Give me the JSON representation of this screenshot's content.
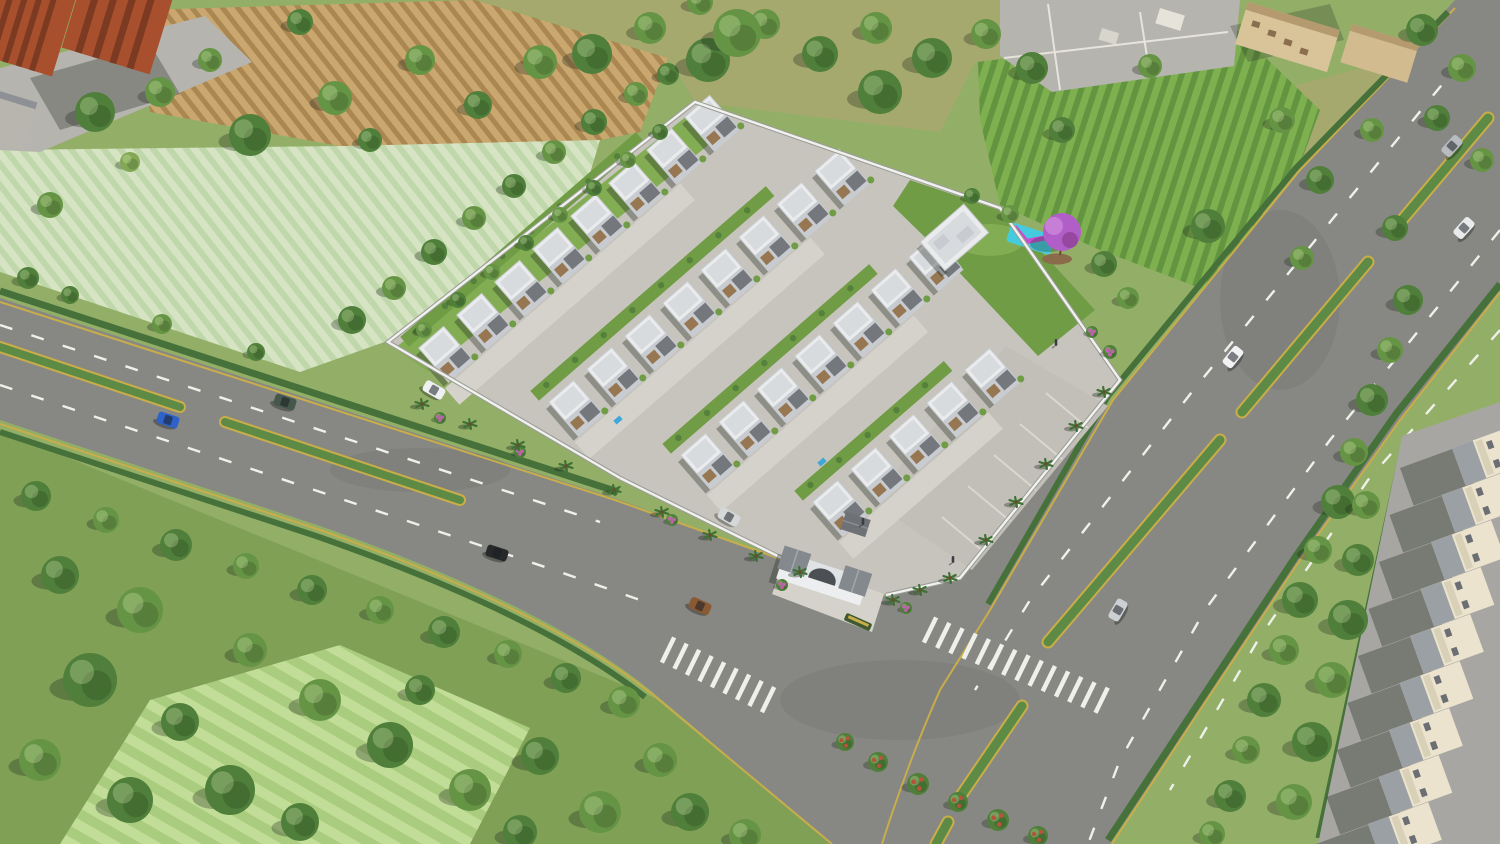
{
  "scene": {
    "title": "Aerial 3D render of a gated villa township beside tree-lined highways",
    "description": "Daytime aerial three-quarter render. A walled residential enclave with four diagonal rows of white two-storey villas, grey concrete internal streets, an arched entrance gatehouse, a clubhouse, a lawn garden with a purple flowering tree and a cyan-magenta play area, and a visitor parking court. The plot sits between two dual-carriageway roads with planted medians, zebra crossings and scattered cars. Surroundings: red-brick apartment blocks and striped crop fields (top-left), olive meadow with trees (top-centre), vineyard rows and tan buildings (top-right), dense trees and mowed fields (bottom-left), and a strip of cream row houses along a service road (right edge).",
    "view": "aerial, looking north-east",
    "time_of_day": "midday"
  },
  "palette": {
    "grass": "#93af67",
    "grassDark": "#7fa055",
    "grassOlive": "#a6a96e",
    "fieldPale": "#d6e4c4",
    "fieldPaleStripe": "#bfd7aa",
    "plough": "#c9a76f",
    "ploughStripe": "#aa8650",
    "vine": "#7fb050",
    "vineStripe": "#639540",
    "mow": "#a9cc7e",
    "mowStripe": "#c2dd97",
    "asphalt": "#878883",
    "laneWhite": "#eef0ea",
    "laneYellow": "#c9ad4a",
    "median": "#5d8b45",
    "hedge": "#46713a",
    "concrete": "#c7c4bd",
    "concreteLight": "#d5d2cb",
    "parking": "#c2bfb8",
    "stall": "#dad7d0",
    "wall": "#f1f2ee",
    "wallShade": "#9b9c98",
    "villaWall": "#c8ccd1",
    "villaRoof": "#e9ebed",
    "villaRoofIn": "#d8dbde",
    "villaDarkRoof": "#74787d",
    "villaBrown": "#967752",
    "lawn": "#6f9c44",
    "lawnLight": "#83ad52",
    "purpleTree": "#b25ec9",
    "purpleTreeLight": "#c77fd6",
    "purpleTreeDark": "#96479f",
    "mulch": "#8a6b4a",
    "playCyan": "#45cbde",
    "playMagenta": "#c44fd1",
    "pool": "#3fa8d8",
    "brick": "#a8502e",
    "brickDark": "#7c3a22",
    "aptRoof": "#8d9196",
    "tan": "#d9c499",
    "tanRoof": "#b49a6e",
    "cream": "#ebe3cd",
    "rowRoof": "#9aa0a4",
    "service": "#a7a6a2",
    "pave": "#b6b4ae",
    "shadow": "rgba(30,38,30,0.34)",
    "treeTones": [
      "#3d6a31",
      "#4f7f3a",
      "#669445",
      "#82a855"
    ],
    "flowerRed": "#b5543b",
    "flowerPink": "#c060ae"
  },
  "site": {
    "villa_total": 28,
    "villa_rows": [
      {
        "x": 418,
        "y": 348,
        "count": 8
      },
      {
        "x": 548,
        "y": 402,
        "count": 8
      },
      {
        "x": 680,
        "y": 455,
        "count": 7
      },
      {
        "x": 812,
        "y": 502,
        "count": 5
      }
    ],
    "row_step": {
      "dx": 38,
      "dy": -33
    },
    "amenities": [
      "entrance gatehouse with arch",
      "security cabin",
      "clubhouse",
      "lawn garden",
      "purple flowering tree",
      "children's play mat",
      "visitor parking court",
      "compound wall with palms",
      "two plunge pools"
    ],
    "pools": [
      [
        618,
        420
      ],
      [
        822,
        462
      ]
    ],
    "parking_stalls": 5
  },
  "vehicles": [
    {
      "name": "blue-sedan",
      "color": "#2e62c8",
      "x": 168,
      "y": 420,
      "rot": 18,
      "where": "left road, lower carriageway"
    },
    {
      "name": "green-pickup",
      "color": "#45584b",
      "x": 285,
      "y": 402,
      "rot": 18,
      "where": "left road, upper carriageway"
    },
    {
      "name": "black-sedan",
      "color": "#26282a",
      "x": 497,
      "y": 553,
      "rot": 18,
      "where": "left road"
    },
    {
      "name": "bronze-sedan",
      "color": "#8a5a35",
      "x": 700,
      "y": 606,
      "rot": 24,
      "where": "junction curve"
    },
    {
      "name": "white-parked-car",
      "color": "#eef0f2",
      "x": 434,
      "y": 390,
      "rot": 30,
      "where": "inside plot near wall"
    },
    {
      "name": "silver-parked-car",
      "color": "#d5d7d9",
      "x": 729,
      "y": 517,
      "rot": 30,
      "where": "inside plot near gate"
    },
    {
      "name": "white-hatchback",
      "color": "#f1f2f4",
      "x": 1233,
      "y": 357,
      "rot": -51,
      "where": "highway"
    },
    {
      "name": "silver-suv",
      "color": "#cdd0d3",
      "x": 1118,
      "y": 610,
      "rot": -60,
      "where": "highway near junction"
    },
    {
      "name": "grey-van",
      "color": "#b9bcbe",
      "x": 1452,
      "y": 146,
      "rot": -48,
      "where": "highway top right"
    },
    {
      "name": "white-car",
      "color": "#e8eaec",
      "x": 1464,
      "y": 228,
      "rot": -48,
      "where": "highway top right"
    }
  ],
  "people": [
    [
      1056,
      343
    ],
    [
      863,
      522
    ],
    [
      953,
      560
    ]
  ],
  "crosswalks": [
    {
      "x": 668,
      "y": 650,
      "n": 9,
      "dx": 12.5,
      "dy": 6.2,
      "rot": 26
    },
    {
      "x": 930,
      "y": 630,
      "n": 14,
      "dx": 13.2,
      "dy": 5.4,
      "rot": 26
    }
  ],
  "row_houses": {
    "count": 9,
    "x0": 1452,
    "y0": 448,
    "dx": -10.5,
    "dy": 47
  },
  "palms": [
    [
      422,
      404
    ],
    [
      470,
      424
    ],
    [
      518,
      445
    ],
    [
      566,
      466
    ],
    [
      614,
      490
    ],
    [
      662,
      512
    ],
    [
      710,
      535
    ],
    [
      756,
      556
    ],
    [
      800,
      572
    ],
    [
      893,
      600
    ],
    [
      920,
      590
    ],
    [
      950,
      578
    ],
    [
      986,
      540
    ],
    [
      1016,
      502
    ],
    [
      1046,
      464
    ],
    [
      1076,
      426
    ],
    [
      1104,
      392
    ]
  ],
  "trees": [
    [
      95,
      112,
      20,
      1
    ],
    [
      160,
      92,
      15,
      2
    ],
    [
      250,
      135,
      21,
      1
    ],
    [
      335,
      98,
      17,
      2
    ],
    [
      300,
      22,
      13,
      1
    ],
    [
      420,
      60,
      15,
      2
    ],
    [
      478,
      105,
      14,
      1
    ],
    [
      540,
      62,
      17,
      2
    ],
    [
      50,
      205,
      13,
      2
    ],
    [
      28,
      278,
      11,
      1
    ],
    [
      130,
      162,
      10,
      3
    ],
    [
      210,
      60,
      12,
      2
    ],
    [
      370,
      140,
      12,
      1
    ],
    [
      352,
      320,
      14,
      1
    ],
    [
      394,
      288,
      12,
      2
    ],
    [
      434,
      252,
      13,
      1
    ],
    [
      474,
      218,
      12,
      2
    ],
    [
      514,
      186,
      12,
      1
    ],
    [
      554,
      152,
      12,
      2
    ],
    [
      594,
      122,
      13,
      1
    ],
    [
      636,
      94,
      12,
      2
    ],
    [
      668,
      74,
      11,
      1
    ],
    [
      424,
      330,
      8,
      2
    ],
    [
      458,
      300,
      8,
      1
    ],
    [
      492,
      272,
      8,
      2
    ],
    [
      526,
      243,
      8,
      1
    ],
    [
      560,
      215,
      8,
      2
    ],
    [
      594,
      188,
      8,
      1
    ],
    [
      628,
      160,
      8,
      2
    ],
    [
      660,
      132,
      8,
      1
    ],
    [
      592,
      54,
      20,
      1
    ],
    [
      650,
      28,
      16,
      2
    ],
    [
      708,
      60,
      22,
      1
    ],
    [
      765,
      24,
      15,
      2
    ],
    [
      820,
      54,
      18,
      1
    ],
    [
      876,
      28,
      16,
      2
    ],
    [
      932,
      58,
      20,
      1
    ],
    [
      986,
      34,
      15,
      2
    ],
    [
      1032,
      68,
      16,
      1
    ],
    [
      737,
      33,
      24,
      2
    ],
    [
      880,
      92,
      22,
      1
    ],
    [
      700,
      2,
      13,
      2
    ],
    [
      1104,
      264,
      13,
      1
    ],
    [
      1128,
      298,
      11,
      2
    ],
    [
      1010,
      214,
      9,
      2
    ],
    [
      972,
      196,
      8,
      1
    ],
    [
      1062,
      130,
      13,
      1
    ],
    [
      1208,
      226,
      17,
      1
    ],
    [
      1150,
      66,
      12,
      2
    ],
    [
      1282,
      120,
      13,
      2
    ],
    [
      1320,
      180,
      14,
      1
    ],
    [
      1372,
      130,
      12,
      2
    ],
    [
      1395,
      228,
      13,
      1
    ],
    [
      1302,
      258,
      12,
      2
    ],
    [
      1422,
      30,
      16,
      1
    ],
    [
      1462,
      68,
      14,
      2
    ],
    [
      1437,
      118,
      13,
      1
    ],
    [
      1482,
      160,
      12,
      2
    ],
    [
      1408,
      300,
      15,
      1
    ],
    [
      1390,
      350,
      13,
      2
    ],
    [
      1372,
      400,
      16,
      1
    ],
    [
      1354,
      452,
      14,
      2
    ],
    [
      1338,
      502,
      17,
      1
    ],
    [
      1318,
      550,
      14,
      2
    ],
    [
      1300,
      600,
      18,
      1
    ],
    [
      1284,
      650,
      15,
      2
    ],
    [
      1264,
      700,
      17,
      1
    ],
    [
      1246,
      750,
      14,
      2
    ],
    [
      1230,
      796,
      16,
      1
    ],
    [
      1212,
      834,
      13,
      2
    ],
    [
      1348,
      620,
      20,
      1
    ],
    [
      1332,
      680,
      18,
      2
    ],
    [
      1312,
      742,
      20,
      1
    ],
    [
      1294,
      802,
      18,
      2
    ],
    [
      1358,
      560,
      16,
      1
    ],
    [
      1366,
      505,
      14,
      2
    ],
    [
      36,
      496,
      15,
      1
    ],
    [
      106,
      520,
      13,
      2
    ],
    [
      176,
      545,
      16,
      1
    ],
    [
      246,
      566,
      13,
      2
    ],
    [
      312,
      590,
      15,
      1
    ],
    [
      380,
      610,
      14,
      2
    ],
    [
      444,
      632,
      16,
      1
    ],
    [
      508,
      654,
      14,
      2
    ],
    [
      566,
      678,
      15,
      1
    ],
    [
      624,
      702,
      16,
      2
    ],
    [
      70,
      295,
      9,
      1
    ],
    [
      162,
      324,
      10,
      2
    ],
    [
      256,
      352,
      9,
      1
    ],
    [
      60,
      575,
      19,
      1
    ],
    [
      140,
      610,
      23,
      2
    ],
    [
      90,
      680,
      27,
      1
    ],
    [
      40,
      760,
      21,
      2
    ],
    [
      180,
      722,
      19,
      1
    ],
    [
      130,
      800,
      23,
      1
    ],
    [
      250,
      650,
      17,
      2
    ],
    [
      230,
      790,
      25,
      1
    ],
    [
      320,
      700,
      21,
      2
    ],
    [
      300,
      822,
      19,
      1
    ],
    [
      390,
      745,
      23,
      1
    ],
    [
      470,
      790,
      21,
      2
    ],
    [
      420,
      690,
      15,
      1
    ],
    [
      540,
      756,
      19,
      1
    ],
    [
      600,
      812,
      21,
      2
    ],
    [
      520,
      832,
      17,
      1
    ],
    [
      660,
      760,
      17,
      2
    ],
    [
      690,
      812,
      19,
      1
    ],
    [
      745,
      835,
      16,
      2
    ],
    [
      878,
      762,
      10,
      4
    ],
    [
      918,
      784,
      11,
      4
    ],
    [
      958,
      802,
      10,
      4
    ],
    [
      998,
      820,
      11,
      4
    ],
    [
      1038,
      836,
      10,
      4
    ],
    [
      845,
      742,
      9,
      4
    ],
    [
      1110,
      352,
      7,
      5
    ],
    [
      1092,
      332,
      6,
      5
    ],
    [
      782,
      585,
      6,
      5
    ],
    [
      906,
      608,
      6,
      5
    ],
    [
      672,
      520,
      6,
      5
    ],
    [
      440,
      418,
      6,
      5
    ],
    [
      520,
      452,
      6,
      5
    ]
  ],
  "surroundings": {
    "top_left": "red-brick apartment towers with paved forecourt",
    "fields": [
      "ploughed brown field",
      "pale green seedling field",
      "vineyard rows",
      "mowed striped meadow",
      "rough olive grassland"
    ],
    "right_edge": "cream row houses with grey roofs along a service road",
    "roads": {
      "left": "dual carriageway with planted median",
      "right": "dual carriageway highway with planted median",
      "markings": [
        "white lane dashes",
        "yellow edge lines",
        "zebra crossings"
      ]
    }
  }
}
